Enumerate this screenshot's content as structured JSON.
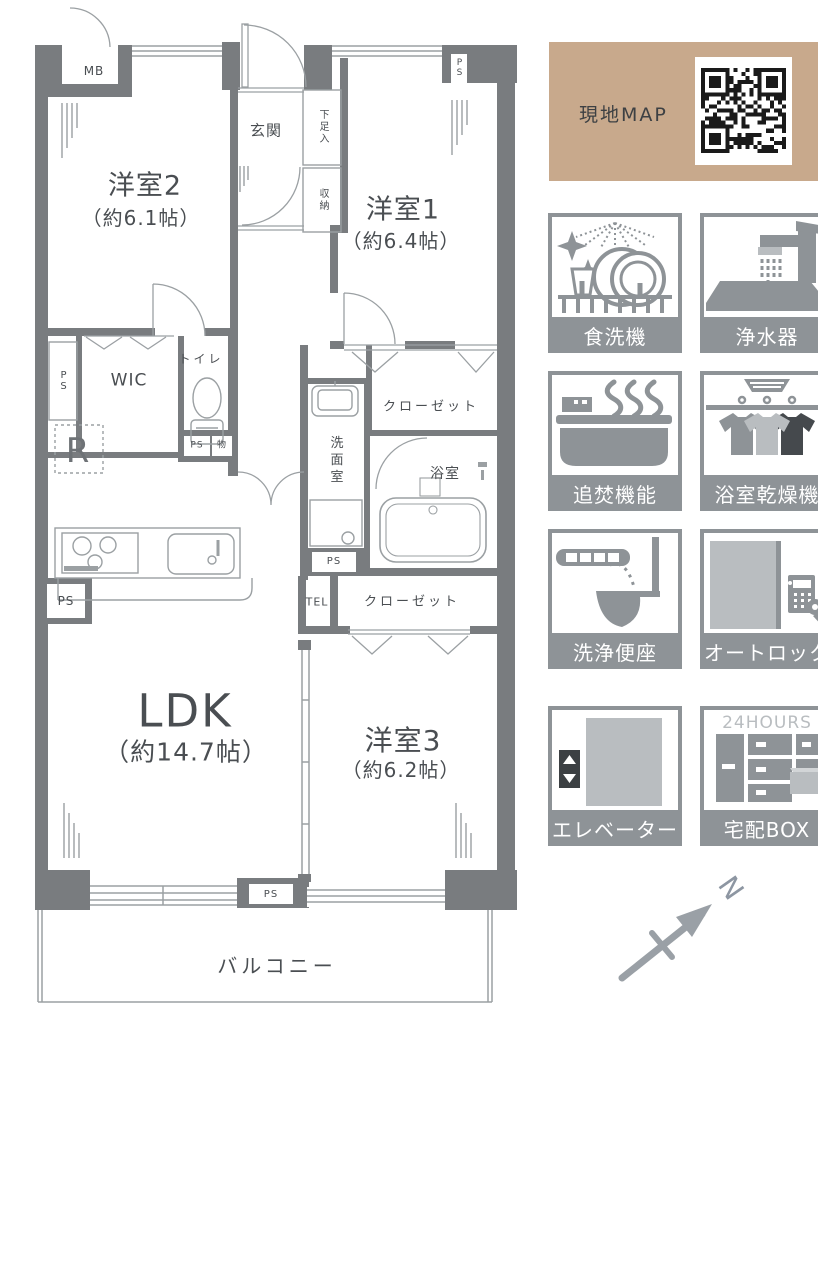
{
  "floor_plan": {
    "rooms": {
      "western2": {
        "name": "洋室2",
        "size": "（約6.1帖）"
      },
      "western1": {
        "name": "洋室1",
        "size": "（約6.4帖）"
      },
      "western3": {
        "name": "洋室3",
        "size": "（約6.2帖）"
      },
      "ldk": {
        "name": "LDK",
        "size": "（約14.7帖）"
      },
      "entrance": "玄関",
      "shoe_cabinet": "下足入",
      "storage": "収納",
      "walk_in_closet": "WIC",
      "toilet": "トイレ",
      "washroom": "洗面室",
      "bathroom": "浴室",
      "closet_upper": "クローゼット",
      "closet_lower": "クローゼット",
      "balcony": "バルコニー",
      "meter_box": "MB",
      "refrigerator_space": "R",
      "telephone": "TEL",
      "small_storage": "物",
      "pipe_space": "PS"
    }
  },
  "map_panel": {
    "title": "現地MAP"
  },
  "amenities": [
    {
      "label": "食洗機"
    },
    {
      "label": "浄水器"
    },
    {
      "label": "追焚機能"
    },
    {
      "label": "浴室乾燥機"
    },
    {
      "label": "洗浄便座"
    },
    {
      "label": "オートロック"
    },
    {
      "label": "エレベーター"
    },
    {
      "label": "宅配BOX",
      "badge": "24HOURS"
    }
  ],
  "compass": {
    "north_label": "N"
  },
  "colors": {
    "wall": "#797c7f",
    "line": "#9ba0a3",
    "text": "#4a4e52",
    "map_bg": "#c8a98c",
    "icon_gray": "#8e9397",
    "icon_light": "#b9bdc0",
    "icon_dark": "#45494d"
  }
}
